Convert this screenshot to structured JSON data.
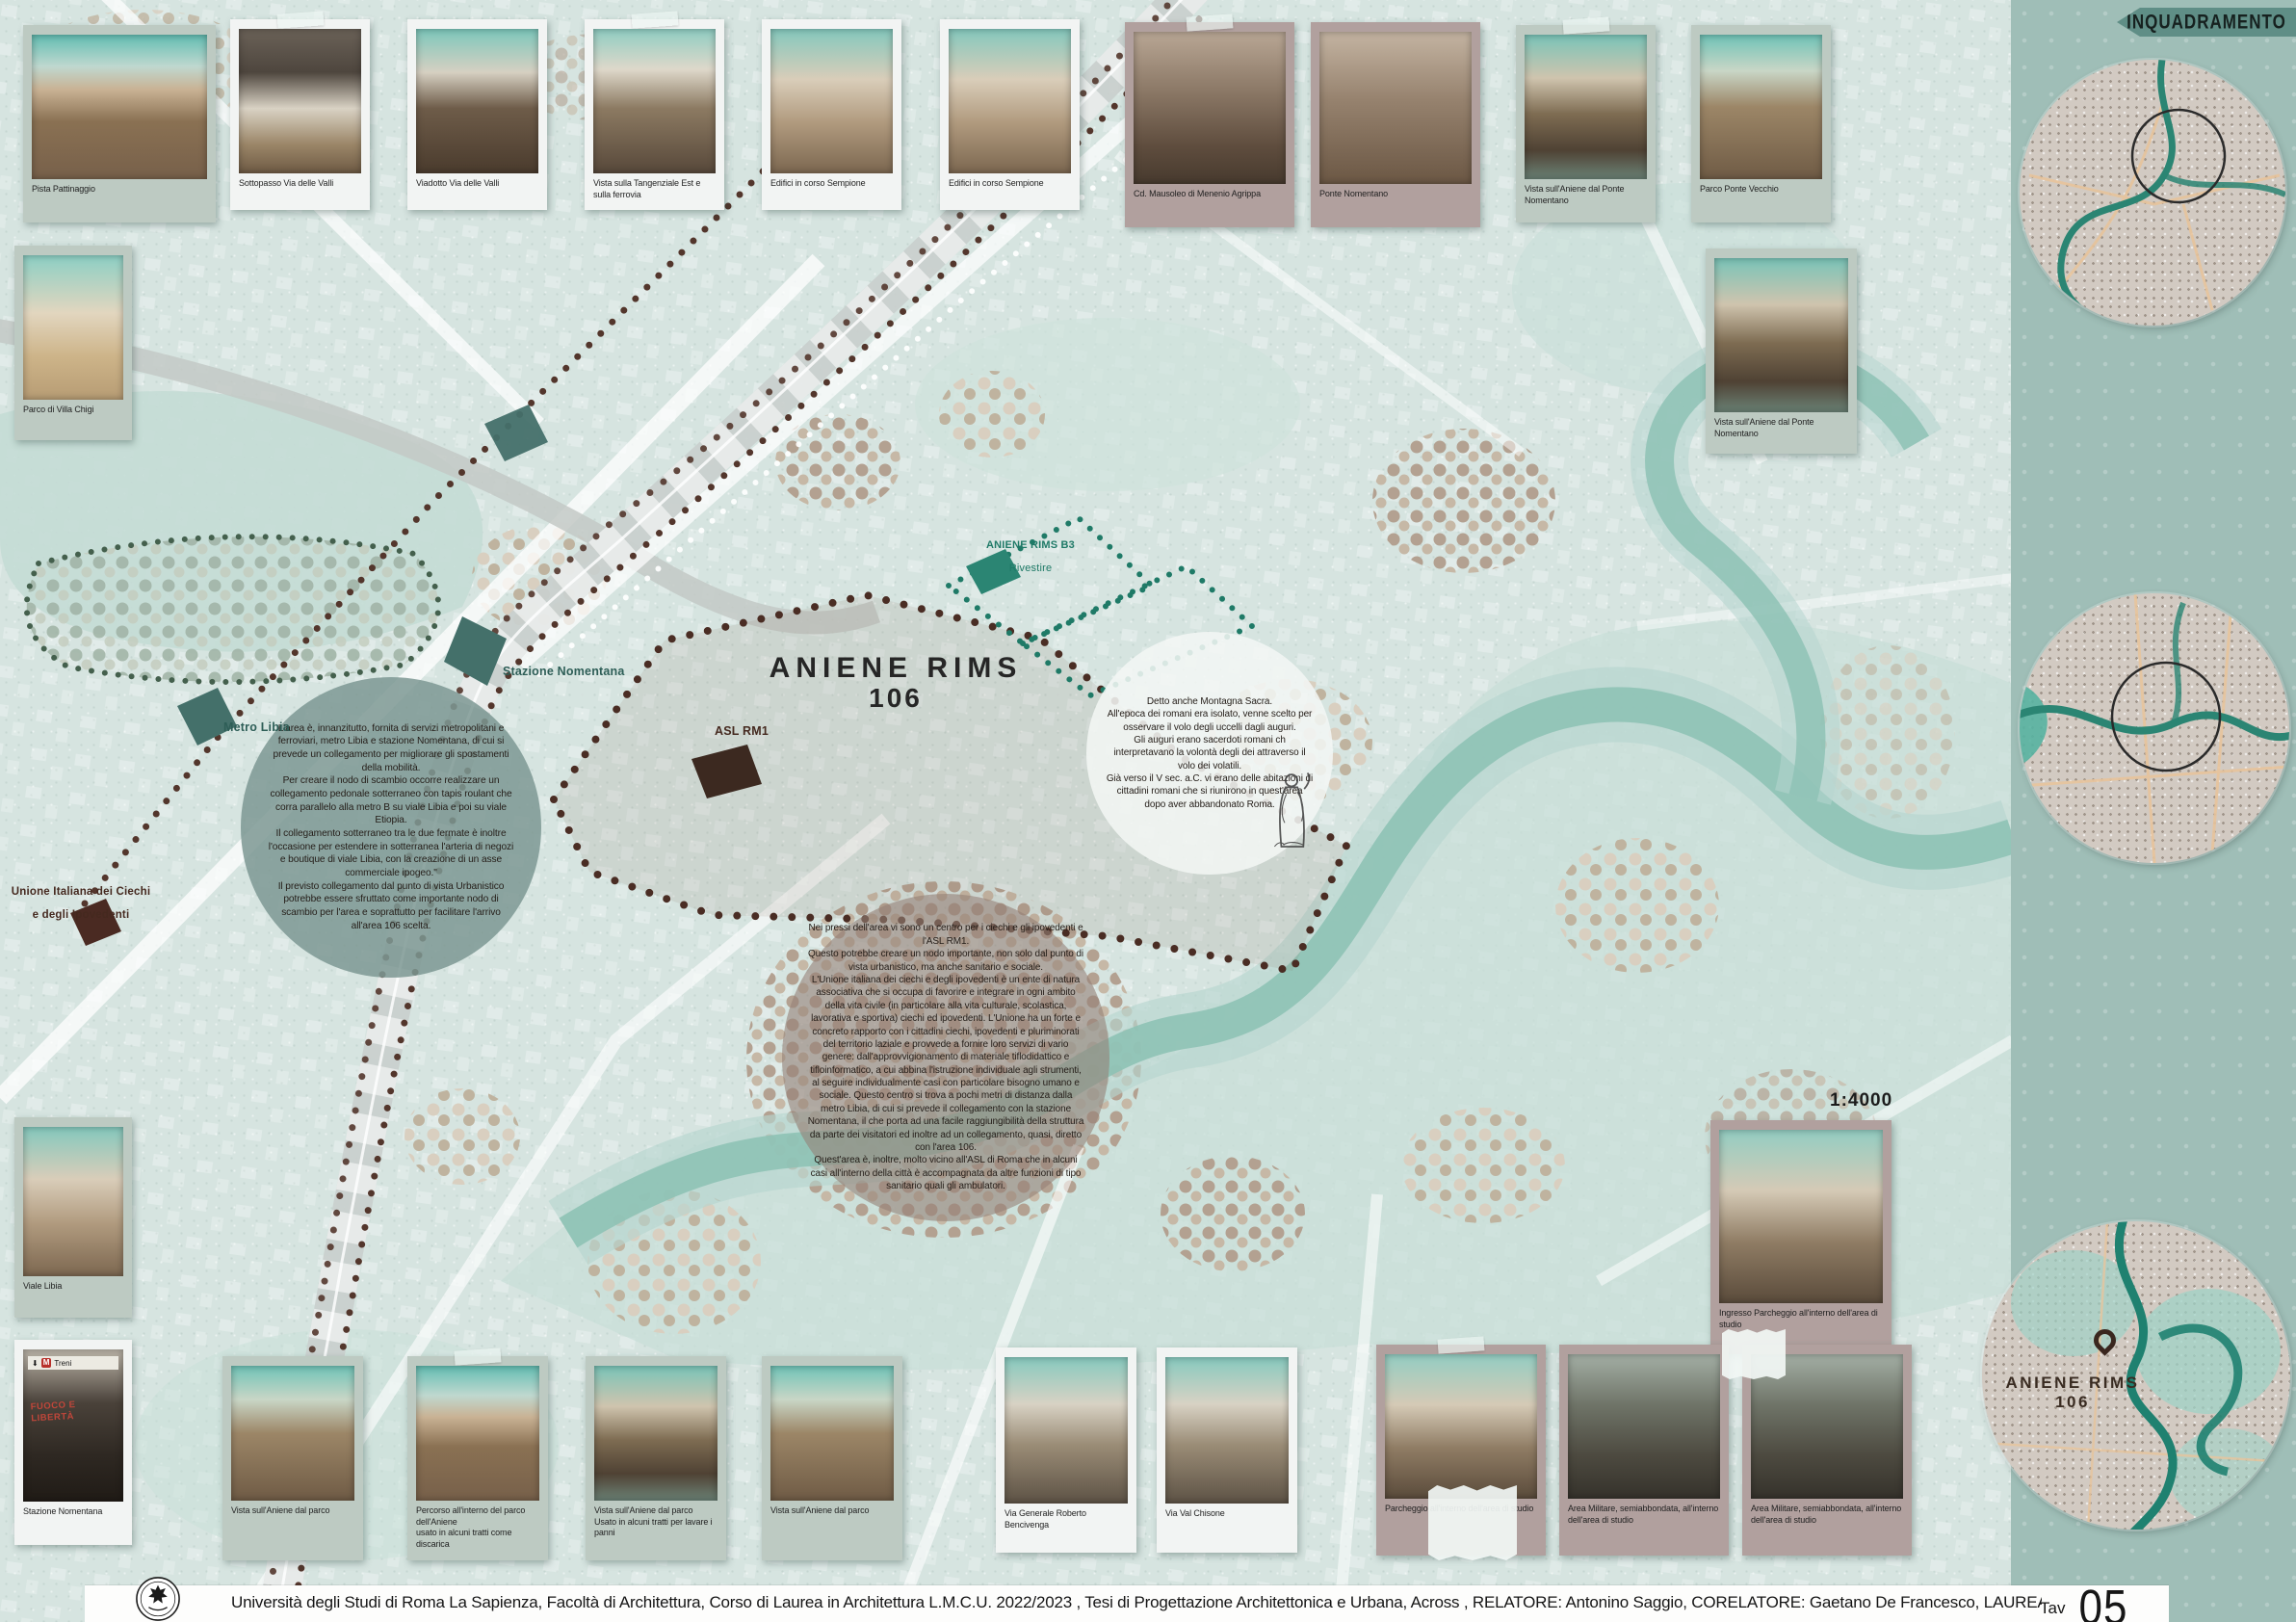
{
  "banner": {
    "label": "INQUADRAMENTO"
  },
  "sidebar": {
    "scale": "1:4000",
    "inset_label_line1": "ANIENE RIMS",
    "inset_label_line2": "106"
  },
  "map": {
    "labels": {
      "metro_libia": "Metro Libia",
      "stazione_nomentana": "Stazione Nomentana",
      "asl_rm1": "ASL RM1",
      "unione_line1": "Unione Italiana dei Ciechi",
      "unione_line2": "e degli Ipovedenti",
      "area_title": "ANIENE RIMS",
      "area_number": "106",
      "b3_line1": "ANIENE RIMS B3",
      "b3_line2": "Rivestire"
    },
    "notes": {
      "mobility": "L'area è, innanzitutto, fornita di servizi metropolitani e ferroviari, metro Libia e stazione Nomentana, di cui si prevede un collegamento per migliorare gli spostamenti della mobilità.\nPer creare il nodo di scambio occorre realizzare un collegamento pedonale sotterraneo con tapis roulant che corra parallelo alla metro B su viale Libia e poi su viale Etiopia.\nIl collegamento sotterraneo tra le due fermate è inoltre l'occasione per estendere in sotterranea l'arteria di negozi e boutique di viale Libia, con la creazione di un asse commerciale ipogeo.\"\nIl previsto collegamento dal punto di vista Urbanistico potrebbe essere sfruttato come importante nodo di scambio per l'area e soprattutto per facilitare l'arrivo all'area 106 scelta.",
      "blind_center": "Nei pressi dell'area vi sono un centro per i ciechi e gli ipovedenti e l'ASL RM1.\nQuesto potrebbe creare un nodo importante, non solo dal punto di vista urbanistico, ma anche sanitario e sociale.\nL'Unione italiana dei ciechi e degli ipovedenti è un ente di natura associativa che si occupa di favorire e integrare in ogni ambito della vita civile (in particolare alla vita culturale, scolastica, lavorativa e sportiva) ciechi ed ipovedenti. L'Unione ha un forte e concreto rapporto con i cittadini ciechi, ipovedenti e pluriminorati del territorio laziale e provvede a fornire loro servizi di vario genere: dall'approvvigionamento di materiale tiflodidattico e tifloinformatico, a cui abbina l'istruzione individuale agli strumenti, al seguire individualmente casi con particolare bisogno umano e sociale. Questo centro si trova a pochi metri di distanza dalla metro Libia, di cui si prevede il collegamento con la stazione Nomentana, il che porta ad una facile raggiungibilità della struttura da parte dei visitatori ed inoltre ad un collegamento, quasi, diretto con l'area 106.\nQuest'area è, inoltre, molto vicino all'ASL di Roma che in alcuni casi all'interno della città è accompagnata da altre funzioni di tipo sanitario quali gli ambulatori.",
      "montagna_sacra": "Detto anche Montagna Sacra.\nAll'epoca dei romani era isolato, venne scelto per osservare il volo degli uccelli dagli auguri.\nGli auguri erano sacerdoti romani ch interpretavano la volontà degli dei attraverso il volo dei volatili.\nGià verso il V sec. a.C. vi erano delle abitazioni di cittadini romani che si riunirono in quest'area dopo aver abbandonato Roma."
    }
  },
  "photos": {
    "top": [
      {
        "caption": "Pista Pattinaggio"
      },
      {
        "caption": "Sottopasso Via delle Valli"
      },
      {
        "caption": "Viadotto Via delle Valli"
      },
      {
        "caption": "Vista sulla Tangenziale Est e sulla ferrovia"
      },
      {
        "caption": "Edifici in corso Sempione"
      },
      {
        "caption": "Edifici in corso Sempione"
      },
      {
        "caption": "Cd. Mausoleo di Menenio Agrippa"
      },
      {
        "caption": "Ponte Nomentano"
      },
      {
        "caption": "Vista sull'Aniene dal Ponte Nomentano"
      },
      {
        "caption": "Parco Ponte Vecchio"
      }
    ],
    "left": [
      {
        "caption": "Parco di Villa Chigi"
      },
      {
        "caption": "Viale Libia"
      },
      {
        "caption": "Stazione Nomentana",
        "sign_arrow": "⬇",
        "sign_metro": "M",
        "sign_text": "Treni",
        "graffiti": "FUOCO E LIBERTÀ"
      }
    ],
    "right": [
      {
        "caption": "Vista sull'Aniene dal Ponte Nomentano"
      },
      {
        "caption": "Ingresso Parcheggio all'interno dell'area di studio"
      }
    ],
    "bottom": [
      {
        "caption": "Vista sull'Aniene dal parco"
      },
      {
        "caption": "Percorso all'interno del parco dell'Aniene\nusato in alcuni tratti come discarica"
      },
      {
        "caption": "Vista sull'Aniene dal parco\nUsato in alcuni tratti per lavare i panni"
      },
      {
        "caption": "Vista sull'Aniene dal parco"
      },
      {
        "caption": "Via Generale Roberto Bencivenga"
      },
      {
        "caption": "Via Val Chisone"
      },
      {
        "caption": "Parcheggio all'interno dell'area di studio"
      },
      {
        "caption": "Area Militare, semiabbondata, all'interno\ndell'area di studio"
      },
      {
        "caption": "Area Militare, semiabbondata, all'interno\ndell'area di studio"
      }
    ]
  },
  "footer": {
    "title": "Università degli Studi di Roma La Sapienza, Facoltà di Architettura, Corso di Laurea in Architettura L.M.C.U. 2022/2023 , Tesi di Progettazione Architettonica e Urbana, Across , RELATORE: Antonino Saggio, CORELATORE: Gaetano De Francesco, LAUREANDA: Mariafrancesca Lo Russo,",
    "tav_label": "Tav",
    "tav_number": "05"
  }
}
